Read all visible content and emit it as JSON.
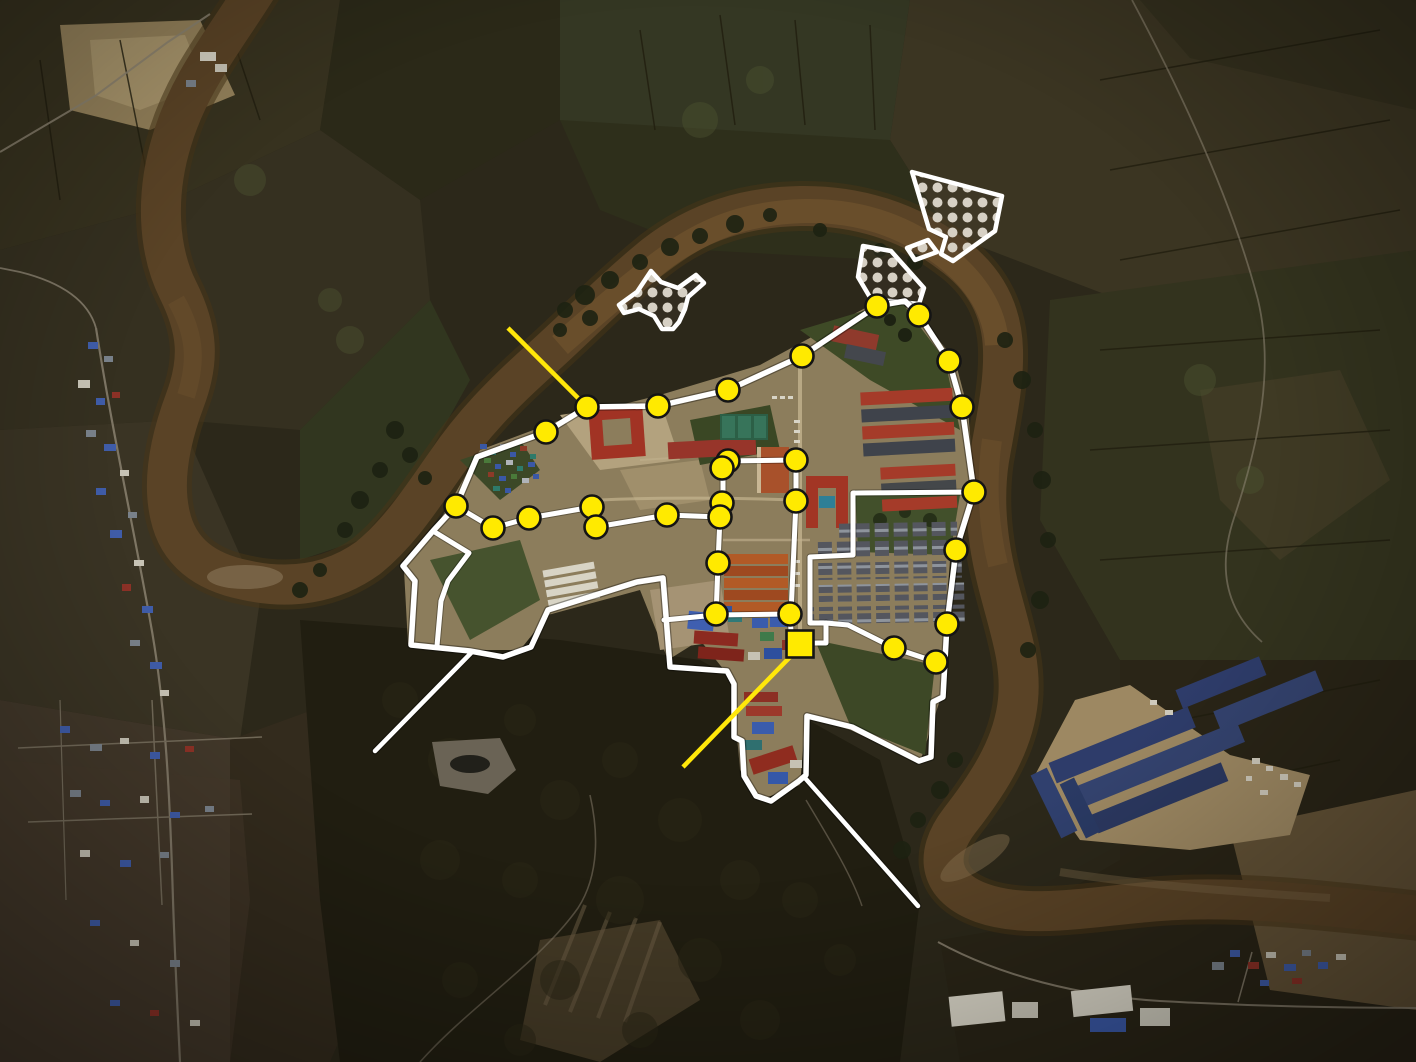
{
  "meta": {
    "type": "annotated-satellite-image",
    "subject": "riverside-compound-overview",
    "width": 1416,
    "height": 1062
  },
  "colors": {
    "marker_fill": "#ffea00",
    "marker_stroke": "#141414",
    "square_fill": "#ffea00",
    "square_stroke": "#141414",
    "boundary": "#ffffff",
    "pointer_line": "#ffffff",
    "leader_line": "#ffe70a",
    "hatch_stroke": "#ffffff",
    "hatch_dot": "#d6d0c4",
    "river": "#5a4326",
    "terrain_base": "#2c281a"
  },
  "annotations": {
    "markers": {
      "radius": 11.5,
      "points": [
        {
          "x": 587,
          "y": 407
        },
        {
          "x": 658,
          "y": 406
        },
        {
          "x": 728,
          "y": 390
        },
        {
          "x": 802,
          "y": 356
        },
        {
          "x": 877,
          "y": 306
        },
        {
          "x": 919,
          "y": 315
        },
        {
          "x": 949,
          "y": 361
        },
        {
          "x": 962,
          "y": 407
        },
        {
          "x": 974,
          "y": 492
        },
        {
          "x": 546,
          "y": 432
        },
        {
          "x": 456,
          "y": 506
        },
        {
          "x": 493,
          "y": 528
        },
        {
          "x": 529,
          "y": 518
        },
        {
          "x": 592,
          "y": 507
        },
        {
          "x": 596,
          "y": 527
        },
        {
          "x": 667,
          "y": 515
        },
        {
          "x": 728,
          "y": 461
        },
        {
          "x": 722,
          "y": 468
        },
        {
          "x": 796,
          "y": 460
        },
        {
          "x": 796,
          "y": 501
        },
        {
          "x": 722,
          "y": 503
        },
        {
          "x": 720,
          "y": 517
        },
        {
          "x": 718,
          "y": 563
        },
        {
          "x": 956,
          "y": 550
        },
        {
          "x": 947,
          "y": 624
        },
        {
          "x": 894,
          "y": 648
        },
        {
          "x": 936,
          "y": 662
        },
        {
          "x": 716,
          "y": 614
        },
        {
          "x": 790,
          "y": 614
        }
      ]
    },
    "highlight_square": {
      "cx": 800,
      "cy": 644,
      "size": 27
    },
    "yellow_leader_lines": [
      {
        "x1": 508,
        "y1": 328,
        "x2": 587,
        "y2": 407
      },
      {
        "x1": 683,
        "y1": 767,
        "x2": 791,
        "y2": 656
      }
    ],
    "white_pointer_lines": [
      {
        "x1": 375,
        "y1": 751,
        "x2": 472,
        "y2": 652
      },
      {
        "x1": 805,
        "y1": 778,
        "x2": 918,
        "y2": 906
      }
    ],
    "hatched_areas": [
      {
        "name": "hatched-area-north-bank",
        "points": "912,172 1002,196 995,231 953,261 941,254 946,237 929,229"
      },
      {
        "name": "hatched-area-connector",
        "points": "907,248 928,240 937,252 915,260"
      },
      {
        "name": "hatched-area-west-fan",
        "points": "863,246 891,251 924,288 919,304 871,299 858,277"
      },
      {
        "name": "hatched-area-center-island",
        "points": "651,271 661,282 678,288 696,275 704,283 688,297 685,309 679,322 673,329 662,329 654,316 639,309 624,313 619,305 637,292"
      }
    ],
    "boundary": {
      "outer": "M456,506 L477,457 L546,432 L587,407 L658,406 L728,390 L802,356 L877,306 L905,301 L919,315 L949,361 L962,407 L974,492 L956,550 L947,624 L945,661 L943,697 L933,702 L931,757 L919,761 L852,727 L807,716 L806,775 L799,781 L771,801 L756,796 L744,776 L742,741 L734,737 L734,684 L727,671 L670,667 L663,578 L637,582 L548,610 L531,647 L503,657 L470,651 L411,645 L415,581 L403,566 L433,531 Z",
      "internal": [
        "M433,531 L469,553 L448,581 L441,601 L437,646",
        "M456,506 L493,528 L529,518 L592,507 L596,527 L667,515 L720,517",
        "M723,455 L723,503 L720,517 L718,563 L716,617",
        "M723,461 L796,460 L796,501 L791,614",
        "M664,620 L716,615 L790,614 L791,631",
        "M813,643 L826,643 L826,623 L810,623 L810,557 L853,555 L853,493 L974,492",
        "M826,623 L848,625 L894,648 L936,662 L942,668"
      ]
    }
  }
}
